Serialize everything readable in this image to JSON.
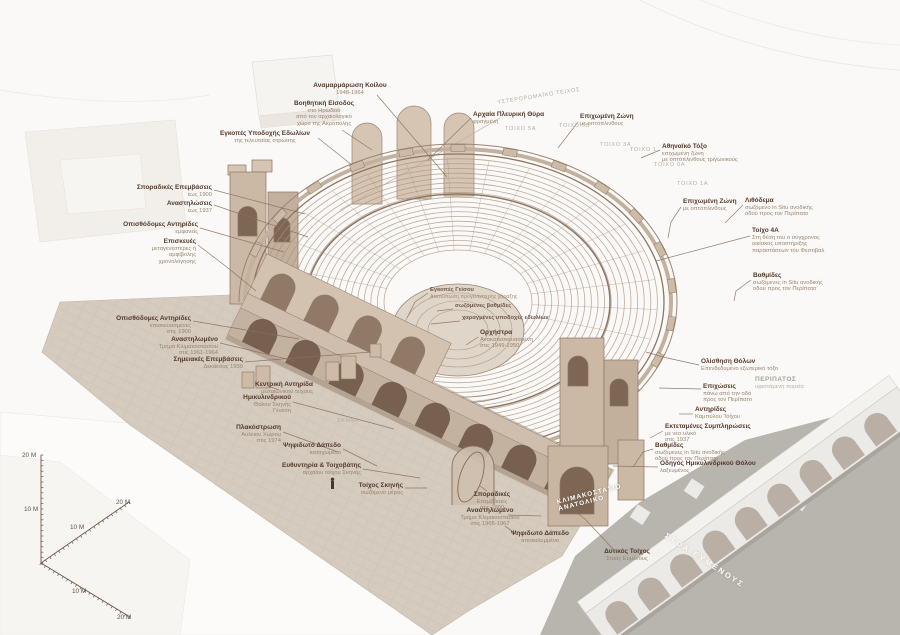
{
  "colors": {
    "paper": "#faf9f7",
    "ink": "#53392b",
    "ink_sub": "#98846f",
    "leader": "#8a6f5c",
    "stone_line": "#9c8571",
    "stone_fill": "#c4b2a0",
    "courtyard": "#d5cbbe",
    "terrace_grey": "#b8b4ae",
    "caption_grey": "#b5aea4",
    "white_caption": "#ffffff"
  },
  "annotations": [
    {
      "align": "center",
      "x": 350,
      "y": 82,
      "lines": [
        "Αναμαρμάρωση Κοίλου",
        "1948-1964"
      ],
      "leader": [
        [
          377,
          95
        ],
        [
          447,
          177
        ]
      ]
    },
    {
      "align": "center",
      "x": 324,
      "y": 100,
      "lines": [
        "Βοηθητική Είσοδος",
        "στο Ηρώδειο",
        "από τον αρχαιολογικό",
        "χώρο της Ακρόπολης"
      ],
      "leader": [
        [
          342,
          130
        ],
        [
          372,
          150
        ]
      ]
    },
    {
      "align": "center",
      "x": 265,
      "y": 130,
      "lines": [
        "Εγκοπές Υποδοχής Εδωλίων",
        "της τελευταίας στρώσης"
      ],
      "leader": [
        [
          318,
          138
        ],
        [
          352,
          165
        ]
      ]
    },
    {
      "align": "left",
      "x": 473,
      "y": 111,
      "lines": [
        "Αρχαία Πλευρική Θύρα",
        "φραγμένη"
      ],
      "leader": [
        [
          471,
          118
        ],
        [
          428,
          160
        ]
      ]
    },
    {
      "align": "right",
      "x": 212,
      "y": 184,
      "lines": [
        "Σποραδικές Επεμβάσεις",
        "έως 1900"
      ],
      "leader": [
        [
          214,
          190
        ],
        [
          305,
          214
        ]
      ]
    },
    {
      "align": "right",
      "x": 212,
      "y": 200,
      "lines": [
        "Αναστηλώσεις",
        "έως 1937"
      ],
      "leader": [
        [
          214,
          205
        ],
        [
          308,
          237
        ]
      ]
    },
    {
      "align": "right",
      "x": 198,
      "y": 221,
      "lines": [
        "Οπισθόδομες Αντηρίδες",
        "εμφανείς"
      ],
      "leader": [
        [
          200,
          228
        ],
        [
          284,
          252
        ]
      ]
    },
    {
      "align": "right",
      "x": 196,
      "y": 238,
      "lines": [
        "Επισκευές",
        "μεταγενέστερες ή",
        "αμφίβολης",
        "χρονολόγησης"
      ],
      "leader": [
        [
          198,
          245
        ],
        [
          228,
          268
        ],
        [
          256,
          291
        ]
      ]
    },
    {
      "align": "right",
      "x": 191,
      "y": 315,
      "lines": [
        "Οπισθόδομες Αντηρίδες",
        "επισκευασμένες",
        "στις 1900"
      ],
      "leader": [
        [
          193,
          321
        ],
        [
          299,
          339
        ]
      ]
    },
    {
      "align": "right",
      "x": 218,
      "y": 336,
      "lines": [
        "Αναστηλωμένο",
        "Τμήμα Κλιμακοστασίου",
        "στις 1961-1964"
      ],
      "leader": [
        [
          220,
          343
        ],
        [
          295,
          361
        ]
      ]
    },
    {
      "align": "right",
      "x": 243,
      "y": 356,
      "lines": [
        "Σημειακές Επεμβάσεις",
        "Δεκαετίας 1930"
      ],
      "leader": [
        [
          245,
          362
        ],
        [
          371,
          352
        ]
      ]
    },
    {
      "align": "right",
      "x": 313,
      "y": 381,
      "lines": [
        "Κεντρική Αντηρίδα",
        "μεσαιωνικού τείχους"
      ],
      "leader": [
        [
          279,
          390
        ],
        [
          268,
          386
        ]
      ]
    },
    {
      "align": "right",
      "x": 291,
      "y": 394,
      "lines": [
        "Ημικυλινδρικού",
        "Θόλου Σκηνής",
        "Γένεση"
      ],
      "leader": [
        [
          293,
          402
        ],
        [
          394,
          429
        ]
      ]
    },
    {
      "align": "right",
      "x": 281,
      "y": 424,
      "lines": [
        "Πλακόστρωση",
        "Αύλειου Χώρου",
        "στις 1974"
      ],
      "leader": [
        [
          283,
          432
        ],
        [
          338,
          452
        ]
      ]
    },
    {
      "align": "right",
      "x": 341,
      "y": 442,
      "lines": [
        "Ψηφιδωτό Δάπεδο",
        "καταχωμένο"
      ],
      "leader": [
        [
          343,
          449
        ],
        [
          377,
          466
        ]
      ]
    },
    {
      "align": "right",
      "x": 361,
      "y": 462,
      "lines": [
        "Ευθυντηρία & Τοιχοβάτης",
        "αρχαίου τοίχου Σκηνής"
      ],
      "leader": [
        [
          363,
          469
        ],
        [
          420,
          478
        ]
      ]
    },
    {
      "align": "right",
      "x": 403,
      "y": 482,
      "lines": [
        "Τοίχος Σκηνής",
        "σωζόμενο μέρος"
      ],
      "leader": [
        [
          405,
          488
        ],
        [
          427,
          488
        ]
      ]
    },
    {
      "align": "center",
      "x": 492,
      "y": 491,
      "lines": [
        "Σποραδικές",
        "Επεμβάσεις",
        "στις 1800"
      ],
      "leader": [
        [
          487,
          491
        ],
        [
          480,
          486
        ]
      ]
    },
    {
      "align": "center",
      "x": 490,
      "y": 507,
      "lines": [
        "Αναστηλωμένο",
        "Τμήμα Κλιμακοστασίου",
        "στις 1965-1967"
      ],
      "leader": [
        [
          508,
          515
        ],
        [
          541,
          516
        ]
      ]
    },
    {
      "align": "center",
      "x": 540,
      "y": 530,
      "lines": [
        "Ψηφιδωτό Δάπεδο",
        "αποκαλυμμένο"
      ],
      "leader": [
        [
          517,
          535
        ],
        [
          505,
          526
        ]
      ]
    },
    {
      "align": "center",
      "x": 627,
      "y": 548,
      "lines": [
        "Δυτικός Τοίχος",
        "Στοάς Ευμένους"
      ],
      "leader": [
        [
          613,
          549
        ],
        [
          585,
          519
        ],
        [
          558,
          499
        ]
      ]
    },
    {
      "align": "left",
      "x": 580,
      "y": 113,
      "lines": [
        "Επιχωμένη Ζώνη",
        "με οπτόπλινθους"
      ],
      "leader": [
        [
          578,
          122
        ],
        [
          558,
          148
        ]
      ]
    },
    {
      "align": "left",
      "x": 662,
      "y": 143,
      "lines": [
        "Αθηναϊκό Τόξο",
        "επιχωμένη ζώνη",
        "με οπτόπλινθους τριγωνικούς"
      ],
      "leader": [
        [
          660,
          150
        ],
        [
          641,
          158
        ]
      ]
    },
    {
      "align": "left",
      "x": 683,
      "y": 198,
      "lines": [
        "Επιχωμένη Ζώνη",
        "με οπτόπλινθους"
      ],
      "leader": [
        [
          681,
          207
        ],
        [
          671,
          222
        ],
        [
          668,
          238
        ]
      ]
    },
    {
      "align": "left",
      "x": 745,
      "y": 197,
      "lines": [
        "Λιθόδεμα",
        "σωζόμενο in Situ ανοδικής",
        "οδού προς τον Περίπατο"
      ],
      "leader": [
        [
          743,
          205
        ],
        [
          725,
          223
        ]
      ]
    },
    {
      "align": "left",
      "x": 752,
      "y": 227,
      "lines": [
        "Τοίχο 4Α",
        "Στη θέση του ο σύγχρονος",
        "οικίσκος υποστήριξης",
        "παραστάσεων του Φεστιβάλ"
      ],
      "leader": [
        [
          750,
          236
        ],
        [
          656,
          261
        ]
      ]
    },
    {
      "align": "left",
      "x": 753,
      "y": 272,
      "lines": [
        "Βαθμίδες",
        "σωζόμενες in Situ ανοδικής",
        "οδού προς τον Περίπατο"
      ],
      "leader": [
        [
          751,
          280
        ],
        [
          736,
          291
        ],
        [
          734,
          301
        ]
      ]
    },
    {
      "align": "left",
      "x": 701,
      "y": 358,
      "lines": [
        "Ολίσθηση Θόλων",
        "Επενδεδυμένο εξωτερικό τόξο"
      ],
      "leader": [
        [
          699,
          365
        ],
        [
          663,
          357
        ],
        [
          646,
          352
        ]
      ]
    },
    {
      "align": "left",
      "x": 703,
      "y": 383,
      "lines": [
        "Επιχώσεις",
        "πάνω από την οδό",
        "προς τον Περίπατο"
      ],
      "leader": [
        [
          701,
          389
        ],
        [
          659,
          388
        ]
      ]
    },
    {
      "align": "left",
      "x": 755,
      "y": 376,
      "style": "muted",
      "lines": [
        "ΠΕΡΙΠΑΤΟΣ",
        "υφιστάμενη πορεία"
      ]
    },
    {
      "align": "left",
      "x": 695,
      "y": 406,
      "lines": [
        "Αντηρίδες",
        "Καμπύλου Τοίχου"
      ],
      "leader": [
        [
          693,
          414
        ],
        [
          679,
          414
        ]
      ]
    },
    {
      "align": "left",
      "x": 665,
      "y": 423,
      "lines": [
        "Εκτεταμένες Συμπληρώσεις",
        "με νέο υλικό",
        "στις 1937"
      ],
      "leader": [
        [
          663,
          431
        ],
        [
          650,
          438
        ]
      ]
    },
    {
      "align": "left",
      "x": 655,
      "y": 442,
      "lines": [
        "Βαθμίδες",
        "σωζόμενες in Situ ανοδικής",
        "οδού προς τον Περίπατο"
      ],
      "leader": [
        [
          653,
          449
        ],
        [
          643,
          452
        ],
        [
          633,
          467
        ]
      ]
    },
    {
      "align": "left",
      "x": 660,
      "y": 460,
      "lines": [
        "Οδηγός Ημικυλινδρικού Θόλου",
        "λαξευμένος"
      ],
      "leader": [
        [
          658,
          467
        ],
        [
          613,
          466
        ]
      ]
    },
    {
      "align": "left",
      "x": 480,
      "y": 329,
      "lines": [
        "Ορχήστρα",
        "Ανακατασκευασμένη",
        "στις 1949-1950"
      ],
      "leader": [
        [
          478,
          337
        ],
        [
          466,
          345
        ]
      ]
    },
    {
      "align": "left",
      "x": 430,
      "y": 287,
      "style": "faint",
      "lines": [
        "Εγκοπές Γείσου",
        "Αποτύπωση προγενέστερης χάραξης"
      ],
      "leader": [
        [
          428,
          293
        ],
        [
          415,
          302
        ],
        [
          407,
          318
        ]
      ]
    },
    {
      "align": "left",
      "x": 455,
      "y": 303,
      "style": "faint",
      "lines": [
        "σωζόμενες βαθμίδες"
      ],
      "leader": [
        [
          453,
          309
        ],
        [
          437,
          311
        ]
      ]
    },
    {
      "align": "left",
      "x": 462,
      "y": 315,
      "style": "faint",
      "lines": [
        "χαραγμένες υποδοχές εδωλίων"
      ],
      "leader": [
        [
          460,
          321
        ],
        [
          431,
          324
        ]
      ]
    }
  ],
  "captions": [
    {
      "x": 337,
      "y": 418,
      "rot": 0,
      "style": "",
      "lines": [
        "ΣΚΗΝΗ"
      ]
    },
    {
      "x": 505,
      "y": 126,
      "rot": 0,
      "style": "",
      "lines": [
        "ΤΟΙΧΟ 5Α"
      ]
    },
    {
      "x": 559,
      "y": 123,
      "rot": 0,
      "style": "",
      "lines": [
        "ΤΟΙΧΟ 5Β"
      ]
    },
    {
      "x": 600,
      "y": 142,
      "rot": 0,
      "style": "",
      "lines": [
        "ΤΟΙΧΟ 3Α"
      ]
    },
    {
      "x": 630,
      "y": 147,
      "rot": 0,
      "style": "",
      "lines": [
        "ΤΟΙΧΟ 1"
      ]
    },
    {
      "x": 654,
      "y": 162,
      "rot": 0,
      "style": "",
      "lines": [
        "ΤΟΙΧΟ 0Α"
      ]
    },
    {
      "x": 677,
      "y": 181,
      "rot": 0,
      "style": "",
      "lines": [
        "ΤΟΙΧΟ 1Α"
      ]
    },
    {
      "x": 497,
      "y": 100,
      "rot": -9,
      "style": "",
      "lines": [
        "ΥΣΤΕΡΟΡΩΜΑΪΚΟ ΤΕΙΧΟΣ"
      ]
    },
    {
      "x": 556,
      "y": 499,
      "rot": -14,
      "style": "white",
      "lines": [
        "ΚΛΙΜΑΚΟΣΤΑΣΙΟ",
        "ΑΝΑΤΟΛΙΚΟ"
      ]
    },
    {
      "x": 668,
      "y": 531,
      "rot": 33,
      "style": "stoa",
      "lines": [
        "ΣΤΟΑ ΕΥΜΕΝΟΥΣ"
      ]
    }
  ],
  "scale_indicator": {
    "labels": [
      {
        "text": "20 M",
        "x": 22,
        "y": 452
      },
      {
        "text": "10 M",
        "x": 24,
        "y": 506
      },
      {
        "text": "20 M",
        "x": 116,
        "y": 499
      },
      {
        "text": "10 M",
        "x": 70,
        "y": 524
      },
      {
        "text": "10 M",
        "x": 72,
        "y": 588
      },
      {
        "text": "20 M",
        "x": 117,
        "y": 614
      }
    ]
  }
}
